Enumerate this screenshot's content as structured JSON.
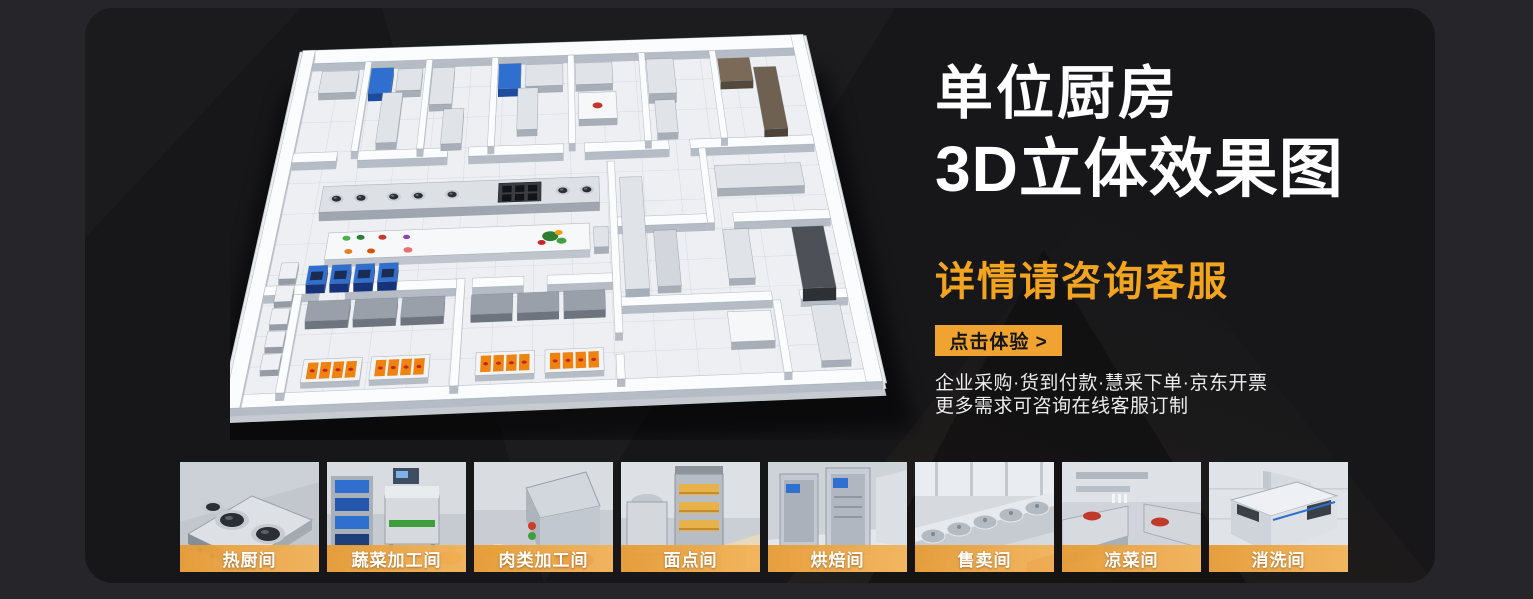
{
  "banner": {
    "title_line1": "单位厨房",
    "title_line2": "3D立体效果图",
    "subtitle": "详情请咨询客服",
    "cta_label": "点击体验 >",
    "desc_line1": "企业采购·货到付款·慧采下单·京东开票",
    "desc_line2": "更多需求可咨询在线客服订制"
  },
  "colors": {
    "accent_orange": "#F2A41F",
    "button_orange": "#F0A330",
    "label_band_orange": "#E69B34",
    "card_background": "#17171A",
    "page_background": "#26262A",
    "title_white": "#FFFFFF"
  },
  "illustration": {
    "name": "kitchen-3d-floorplan",
    "description": "3D isometric rendering of a commercial unit kitchen floor plan"
  },
  "gallery": {
    "items": [
      {
        "label": "热厨间",
        "scene": "hot-kitchen"
      },
      {
        "label": "蔬菜加工间",
        "scene": "vegetable-processing"
      },
      {
        "label": "肉类加工间",
        "scene": "meat-processing"
      },
      {
        "label": "面点间",
        "scene": "pastry-room"
      },
      {
        "label": "烘焙间",
        "scene": "baking-room"
      },
      {
        "label": "售卖间",
        "scene": "selling-room"
      },
      {
        "label": "凉菜间",
        "scene": "cold-dish-room"
      },
      {
        "label": "消洗间",
        "scene": "washing-room"
      }
    ]
  }
}
